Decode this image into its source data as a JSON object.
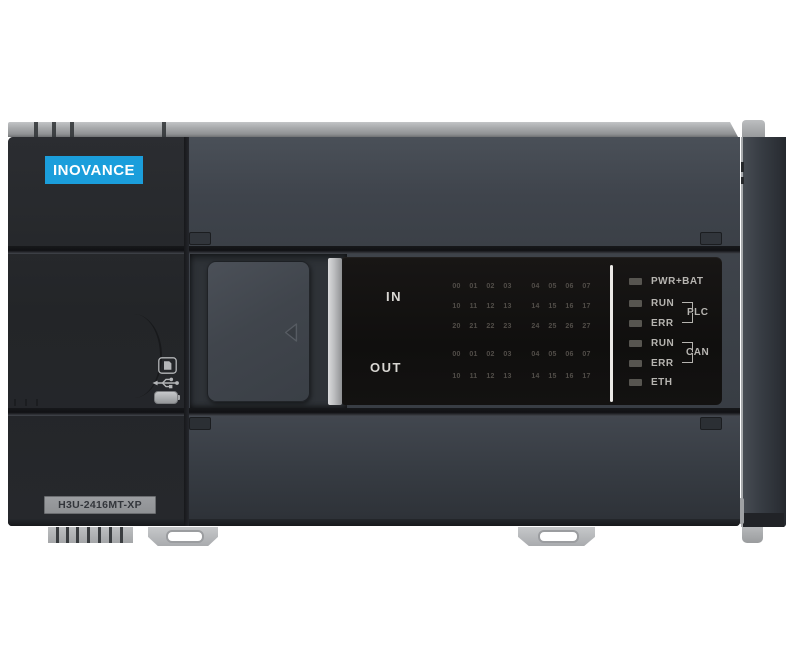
{
  "brand": {
    "logo_text": "INOVANCE"
  },
  "model_badge": {
    "text": "H3U-2416MT-XP"
  },
  "io_panel": {
    "in_label": "IN",
    "out_label": "OUT",
    "in_rows": [
      [
        "00",
        "01",
        "02",
        "03",
        "04",
        "05",
        "06",
        "07"
      ],
      [
        "10",
        "11",
        "12",
        "13",
        "14",
        "15",
        "16",
        "17"
      ],
      [
        "20",
        "21",
        "22",
        "23",
        "24",
        "25",
        "26",
        "27"
      ]
    ],
    "out_rows": [
      [
        "00",
        "01",
        "02",
        "03",
        "04",
        "05",
        "06",
        "07"
      ],
      [
        "10",
        "11",
        "12",
        "13",
        "14",
        "15",
        "16",
        "17"
      ]
    ]
  },
  "status_leds": {
    "pwr": "PWR+BAT",
    "plc": {
      "run": "RUN",
      "err": "ERR",
      "group": "PLC"
    },
    "can": {
      "run": "RUN",
      "err": "ERR",
      "group": "CAN"
    },
    "eth": "ETH"
  },
  "side_icons": [
    "sd-card-icon",
    "usb-icon",
    "battery-icon"
  ],
  "colors": {
    "accent_blue": "#1b9edb",
    "body_charcoal": "#3a3f46",
    "left_panel_dark": "#232528",
    "led_window_black": "#121010",
    "rail_gray": "#a7a9ab",
    "white_separator": "#ebe9e6"
  }
}
